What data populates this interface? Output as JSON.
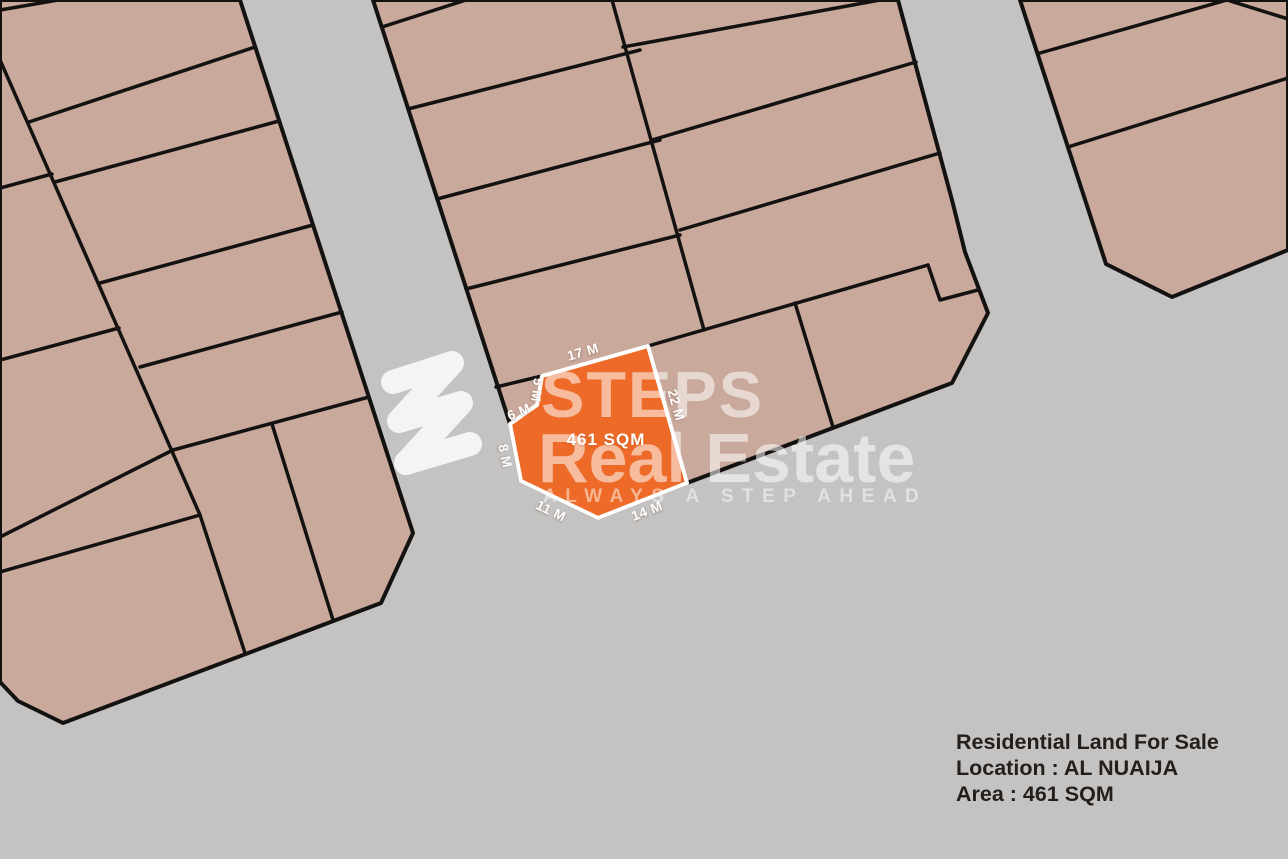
{
  "watermark": {
    "line1": "STEPS",
    "line2": "Real Estate",
    "tagline": "ALWAYS A STEP AHEAD",
    "logo": "steps-swoosh-logo"
  },
  "plot": {
    "area": "461 SQM",
    "dims": {
      "top": "17 M",
      "right": "22 M",
      "bottom_right": "14 M",
      "bottom_left": "11 M",
      "left": "8 M",
      "notch_lower": "6 M",
      "notch_upper": "5 M"
    }
  },
  "info": {
    "title": "Residential Land For Sale",
    "location": "Location : AL NUAIJA",
    "area": "Area : 461 SQM"
  },
  "colors": {
    "road": "#c4c3c2",
    "parcel": "#c9a99c",
    "boundary": "#141211",
    "plot_fill": "#ee6a28",
    "plot_border": "#ffffff",
    "watermark": "#ffffff",
    "info_text": "#221f1d"
  }
}
